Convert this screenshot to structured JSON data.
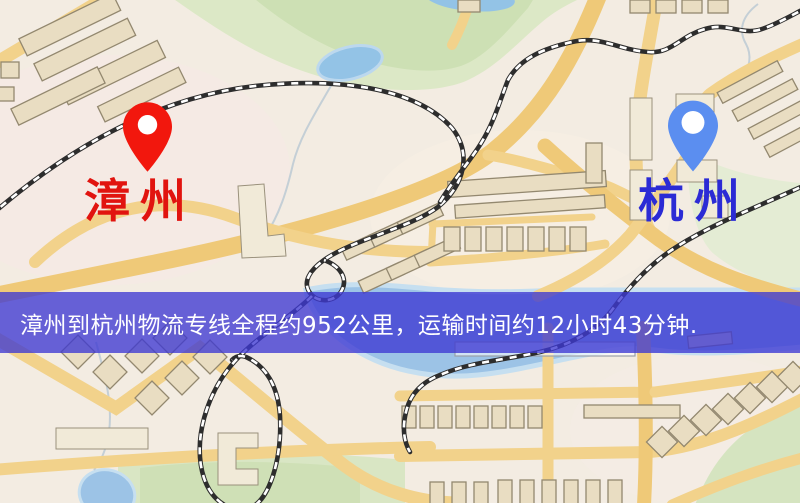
{
  "banner": {
    "text": "漳州到杭州物流专线全程约952公里，运输时间约12小时43分钟.",
    "text_color": "#ffffff",
    "background_color": "#3d39d2",
    "distance_km": "952",
    "transit_time": "12小时43分钟"
  },
  "markers": {
    "origin": {
      "label": "漳州",
      "pin_color": "#f2170d",
      "pin_hole_color": "#ffffff",
      "label_color": "#e1140f"
    },
    "destination": {
      "label": "杭州",
      "pin_color": "#5b8ef0",
      "pin_hole_color": "#ffffff",
      "label_color": "#2b2bd5"
    }
  },
  "map_palette": {
    "background": "#f3ece2",
    "road_yellow": "#f2d28b",
    "park_green": "#d8e6c6",
    "water_blue": "#9cc3e6",
    "building_tan": "#e9ddc2",
    "railway_dark": "#2d2d2d"
  }
}
